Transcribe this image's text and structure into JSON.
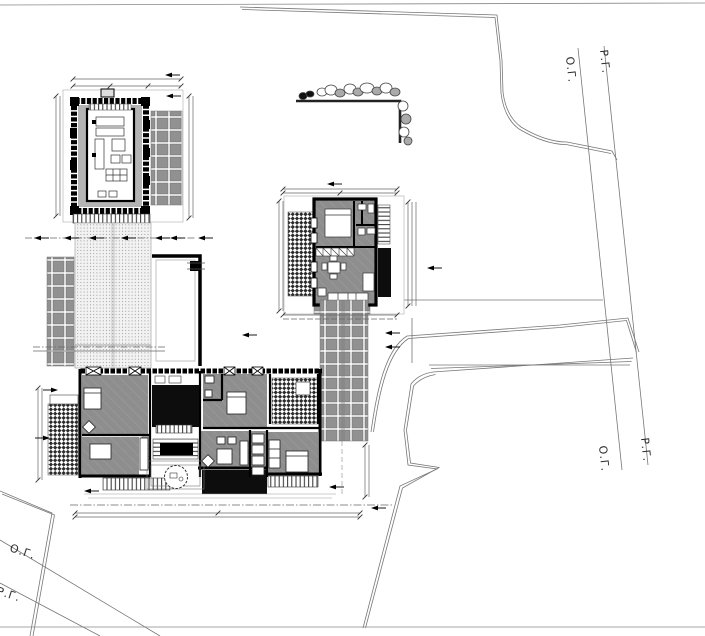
{
  "drawing": {
    "kind": "architectural-site-plan",
    "boundary_labels": {
      "og": "О.Г.",
      "rg": "Р.Г."
    },
    "palette": {
      "paper": "#ffffff",
      "wall_black": "#000000",
      "deck_black": "#0d0d0d",
      "floor_gray": "#8e8e8e",
      "veranda_gray": "#b4b4b4",
      "tile_gray": "#919191",
      "boundary_line": "#777777",
      "dimension_line": "#666666",
      "label_text": "#2b2b2b"
    },
    "site_elements": [
      "property-boundary",
      "street-line-og",
      "street-line-rg",
      "pavilion",
      "pavilion-tile-terrace",
      "garden-path",
      "west-tile-terrace",
      "courtyard-lawn",
      "guest-house",
      "guest-yard-fence",
      "driveway-tiles",
      "access-road",
      "main-house",
      "hedge-with-trees",
      "dimension-lines",
      "direction-arrows",
      "round-tree"
    ]
  }
}
